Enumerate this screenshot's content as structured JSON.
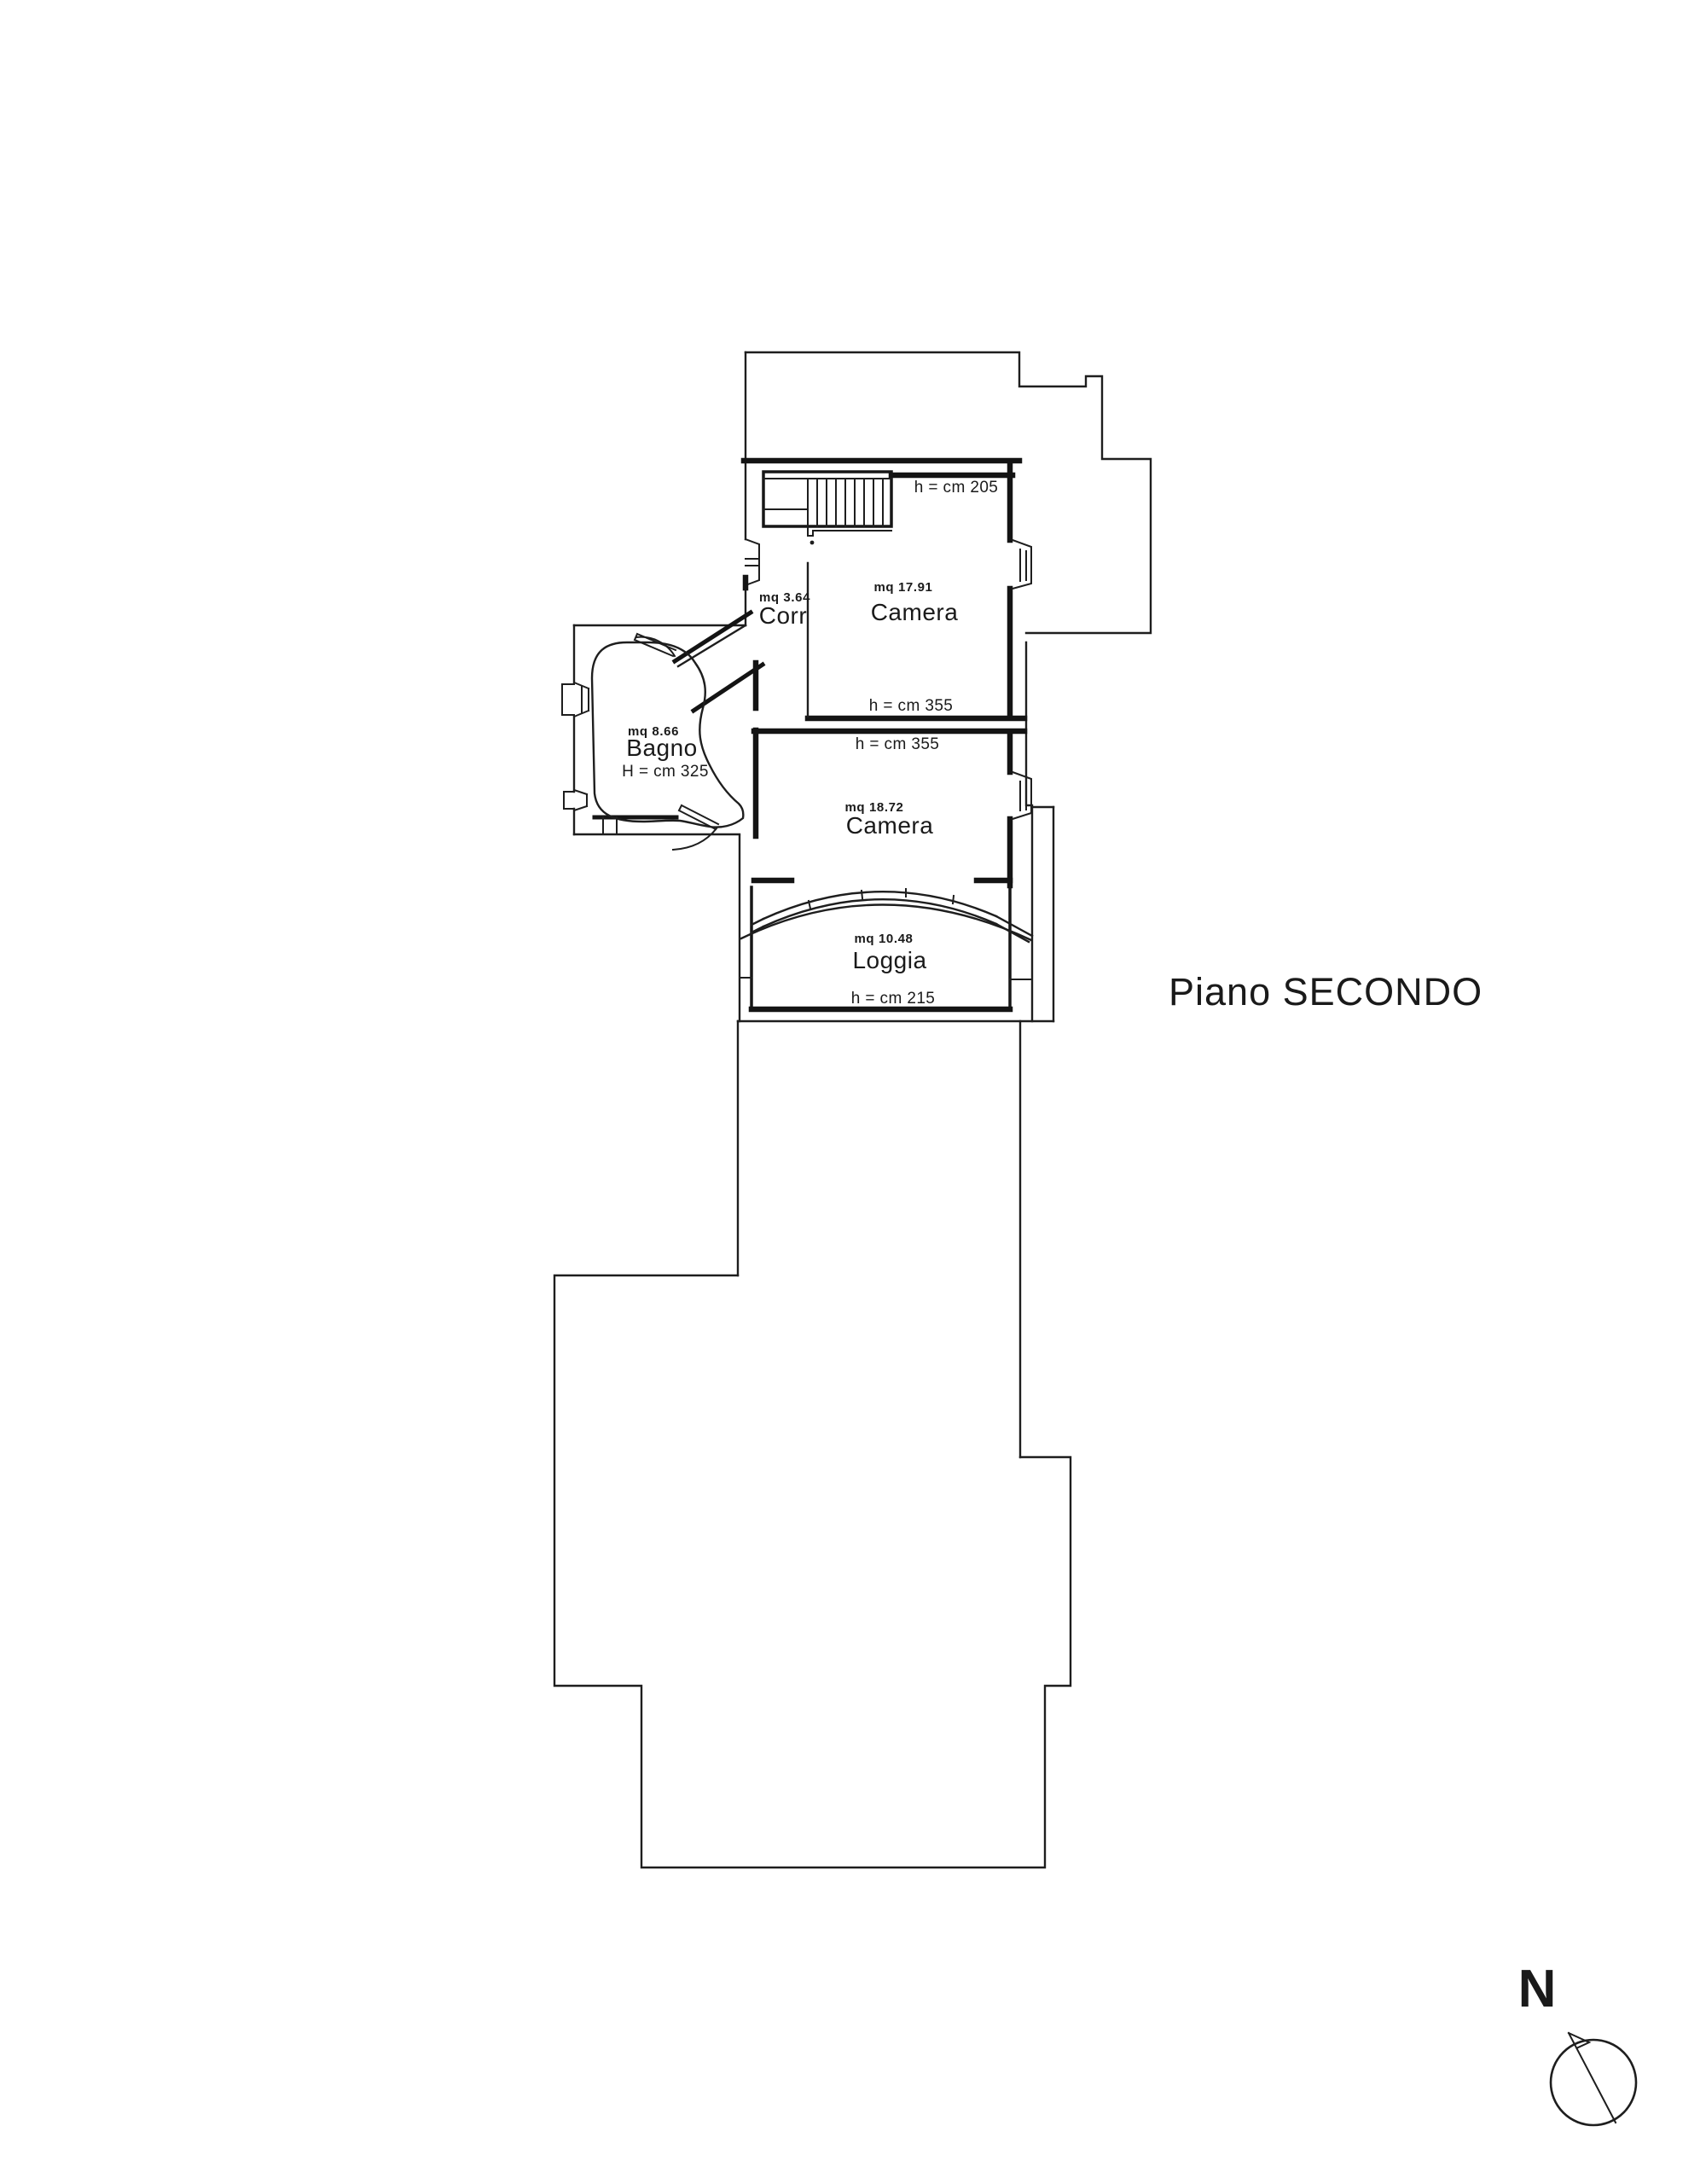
{
  "page": {
    "background": "#ffffff",
    "ink_color": "#1c1c1c",
    "drawing_type": "floor-plan"
  },
  "title": {
    "label": "Piano SECONDO"
  },
  "north": {
    "label": "N"
  },
  "rooms": {
    "camera_top": {
      "name": "Camera",
      "area": "mq 17.91",
      "height_top": "h = cm 205",
      "height_bottom": "h = cm 355"
    },
    "camera_mid": {
      "name": "Camera",
      "area": "mq 18.72",
      "height_top": "h = cm 355"
    },
    "bagno": {
      "name": "Bagno",
      "area": "mq 8.66",
      "height": "H = cm 325"
    },
    "corridoio": {
      "name": "Corr",
      "area": "mq 3.64"
    },
    "loggia": {
      "name": "Loggia",
      "area": "mq 10.48",
      "height": "h = cm 215"
    }
  }
}
